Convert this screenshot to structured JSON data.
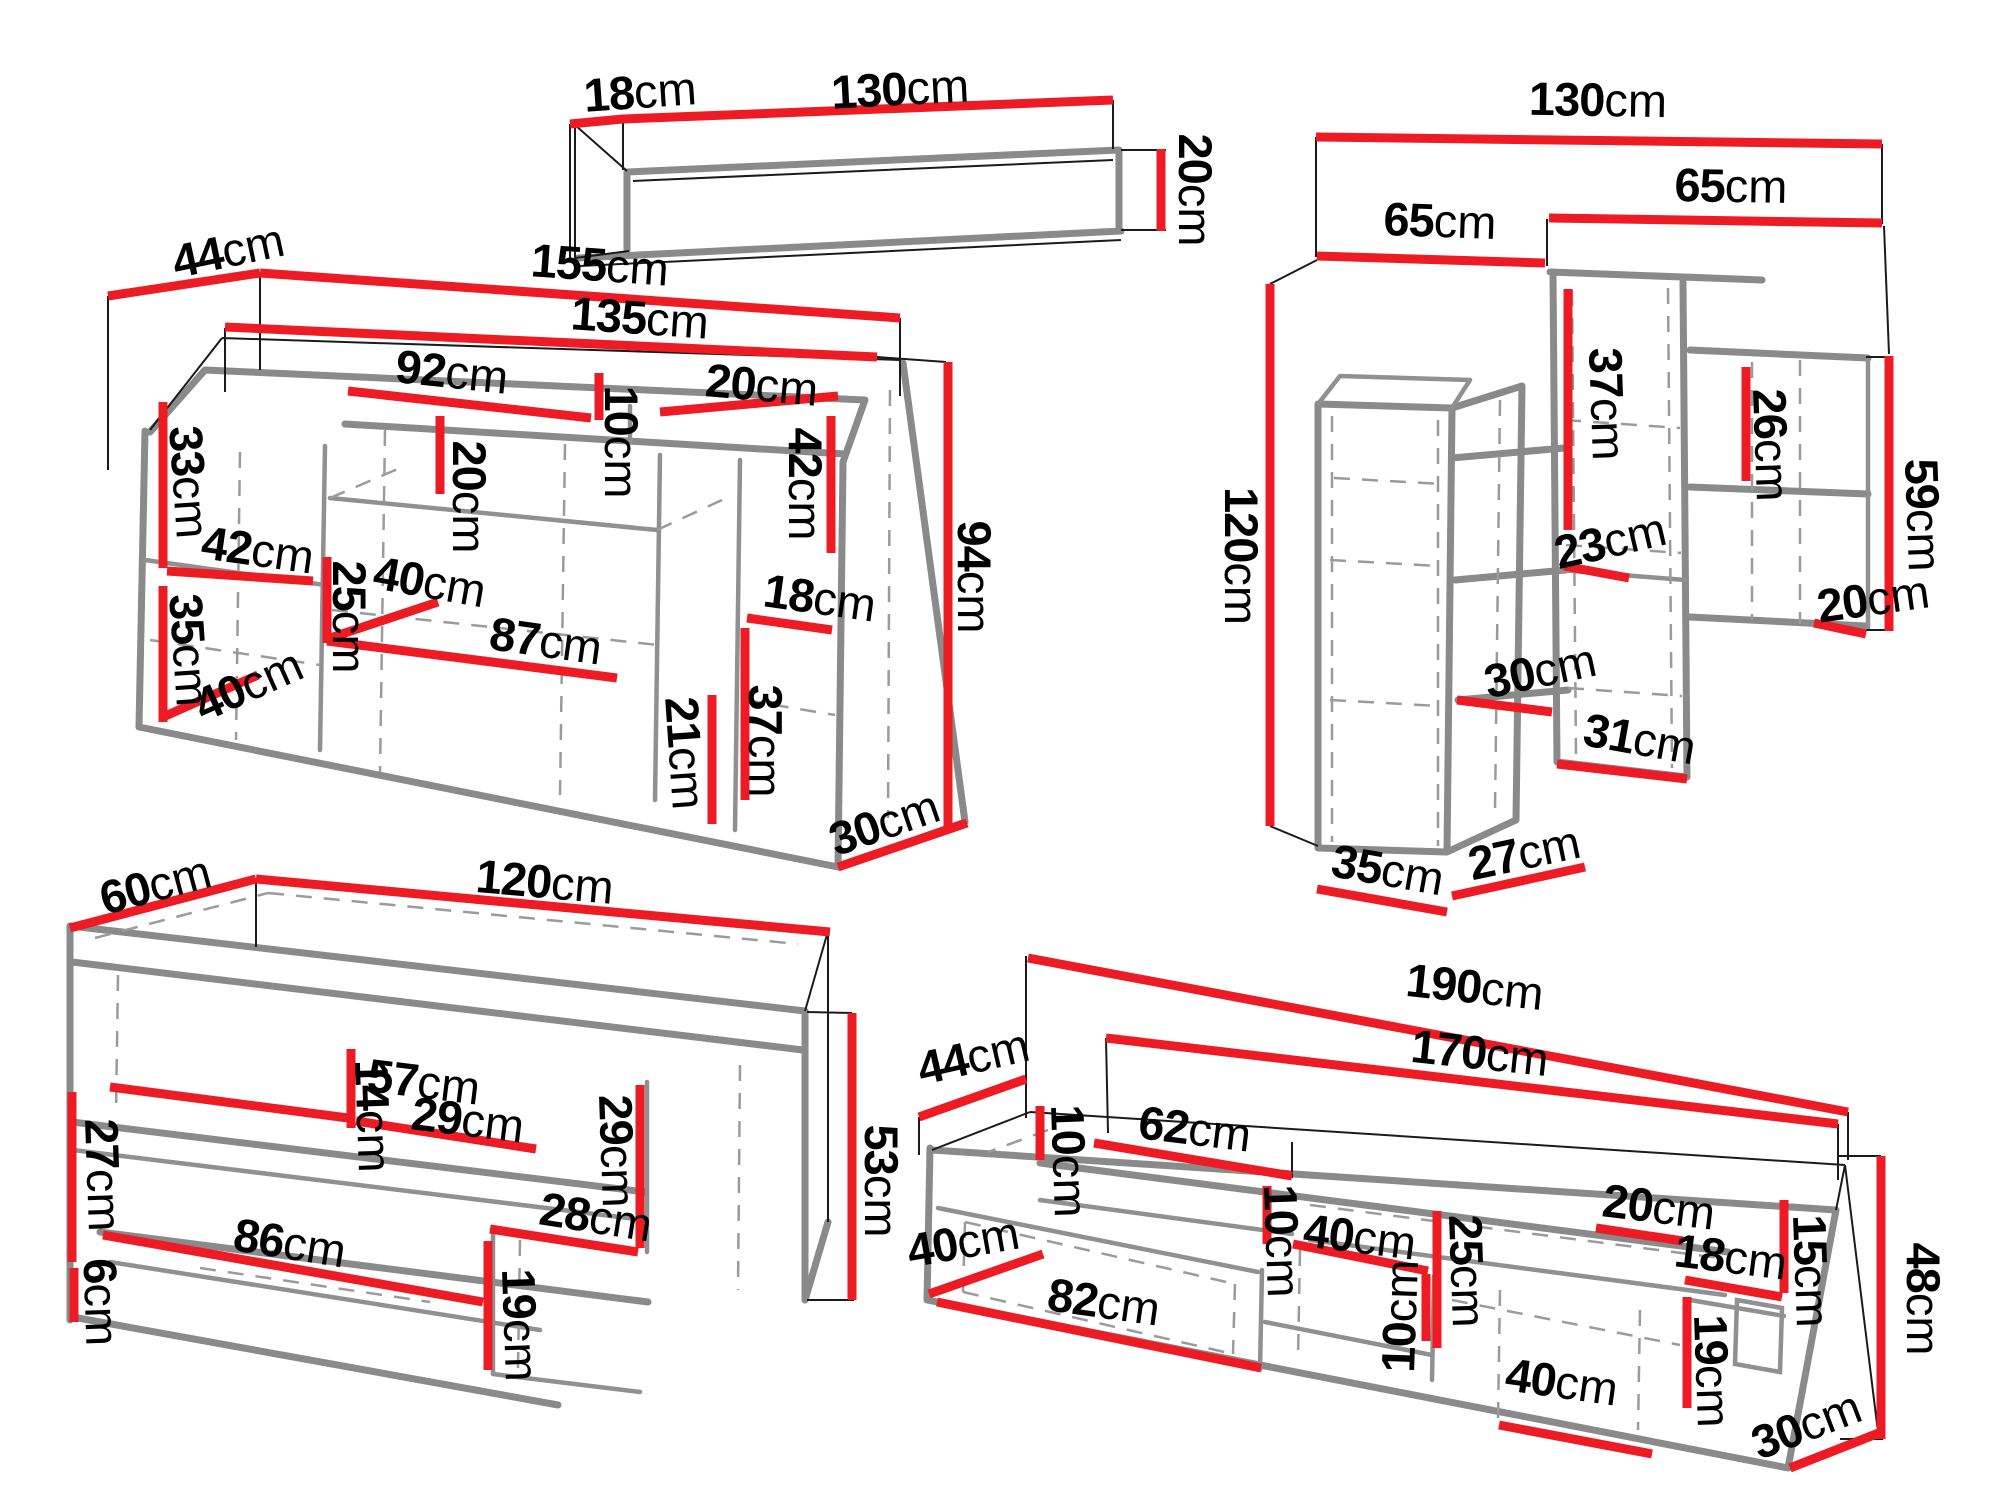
{
  "unit_suffix": "cm",
  "colors": {
    "dimension_line": "#ec1b24",
    "furniture_line": "#8a8a8a",
    "hidden_line": "#9b9b9b",
    "extension_line": "#1b1b1b",
    "label_text": "#000000",
    "background": "#ffffff"
  },
  "furniture": {
    "wall_shelf": {
      "name": "hanging wall shelf",
      "dims": {
        "depth": {
          "v": "18",
          "u": "cm"
        },
        "width": {
          "v": "130",
          "u": "cm"
        },
        "height": {
          "v": "20",
          "u": "cm"
        }
      }
    },
    "sideboard": {
      "name": "sideboard",
      "dims": {
        "depth": {
          "v": "44",
          "u": "cm"
        },
        "width_total": {
          "v": "155",
          "u": "cm"
        },
        "width_inner": {
          "v": "135",
          "u": "cm"
        },
        "niche_width": {
          "v": "92",
          "u": "cm"
        },
        "niche_right_width": {
          "v": "20",
          "u": "cm"
        },
        "niche_height": {
          "v": "10",
          "u": "cm"
        },
        "door_upper_left_height": {
          "v": "33",
          "u": "cm"
        },
        "shelf_gap_upper": {
          "v": "20",
          "u": "cm"
        },
        "left_width": {
          "v": "42",
          "u": "cm"
        },
        "shelf_gap_lower": {
          "v": "25",
          "u": "cm"
        },
        "shelf_depth": {
          "v": "40",
          "u": "cm"
        },
        "door_lower_left_height": {
          "v": "35",
          "u": "cm"
        },
        "base_depth_left": {
          "v": "40",
          "u": "cm"
        },
        "middle_width": {
          "v": "87",
          "u": "cm"
        },
        "right_open_height": {
          "v": "42",
          "u": "cm"
        },
        "right_width": {
          "v": "18",
          "u": "cm"
        },
        "right_door_height": {
          "v": "37",
          "u": "cm"
        },
        "bottom_height": {
          "v": "21",
          "u": "cm"
        },
        "base_depth_right": {
          "v": "30",
          "u": "cm"
        },
        "height_total": {
          "v": "94",
          "u": "cm"
        }
      }
    },
    "wall_unit": {
      "name": "wall storage unit",
      "dims": {
        "width_total": {
          "v": "130",
          "u": "cm"
        },
        "left_width": {
          "v": "65",
          "u": "cm"
        },
        "right_width": {
          "v": "65",
          "u": "cm"
        },
        "left_height": {
          "v": "120",
          "u": "cm"
        },
        "right_top_height": {
          "v": "37",
          "u": "cm"
        },
        "shelf_gap_right": {
          "v": "23",
          "u": "cm"
        },
        "shelf_gap_left": {
          "v": "30",
          "u": "cm"
        },
        "bottom_right_width": {
          "v": "31",
          "u": "cm"
        },
        "base_width": {
          "v": "35",
          "u": "cm"
        },
        "base_depth": {
          "v": "27",
          "u": "cm"
        },
        "wing_gap": {
          "v": "26",
          "u": "cm"
        },
        "wing_height": {
          "v": "59",
          "u": "cm"
        },
        "wing_shelf_depth": {
          "v": "20",
          "u": "cm"
        }
      }
    },
    "coffee_table": {
      "name": "coffee table",
      "dims": {
        "depth": {
          "v": "60",
          "u": "cm"
        },
        "width": {
          "v": "120",
          "u": "cm"
        },
        "shelf_left_width": {
          "v": "57",
          "u": "cm"
        },
        "divider_height": {
          "v": "14",
          "u": "cm"
        },
        "shelf_right_width": {
          "v": "29",
          "u": "cm"
        },
        "side_upper_height": {
          "v": "27",
          "u": "cm"
        },
        "plinth_height": {
          "v": "6",
          "u": "cm"
        },
        "bottom_width": {
          "v": "86",
          "u": "cm"
        },
        "bottom_right_width": {
          "v": "28",
          "u": "cm"
        },
        "right_open_height": {
          "v": "29",
          "u": "cm"
        },
        "right_lower_height": {
          "v": "19",
          "u": "cm"
        },
        "height_total": {
          "v": "53",
          "u": "cm"
        }
      }
    },
    "tv_stand": {
      "name": "TV stand",
      "dims": {
        "width_total": {
          "v": "190",
          "u": "cm"
        },
        "width_inner": {
          "v": "170",
          "u": "cm"
        },
        "depth": {
          "v": "44",
          "u": "cm"
        },
        "niche_height": {
          "v": "10",
          "u": "cm"
        },
        "niche_width": {
          "v": "62",
          "u": "cm"
        },
        "base_depth_left": {
          "v": "40",
          "u": "cm"
        },
        "drawer_width": {
          "v": "82",
          "u": "cm"
        },
        "mid_gap_height": {
          "v": "10",
          "u": "cm"
        },
        "mid_width": {
          "v": "40",
          "u": "cm"
        },
        "mid_gap_height2": {
          "v": "10",
          "u": "cm"
        },
        "mid_open_height": {
          "v": "25",
          "u": "cm"
        },
        "door_width": {
          "v": "40",
          "u": "cm"
        },
        "top_right_width": {
          "v": "20",
          "u": "cm"
        },
        "right_width": {
          "v": "18",
          "u": "cm"
        },
        "right_gap_height": {
          "v": "15",
          "u": "cm"
        },
        "right_lower_height": {
          "v": "19",
          "u": "cm"
        },
        "height_right": {
          "v": "48",
          "u": "cm"
        },
        "base_depth_right": {
          "v": "30",
          "u": "cm"
        }
      }
    }
  }
}
